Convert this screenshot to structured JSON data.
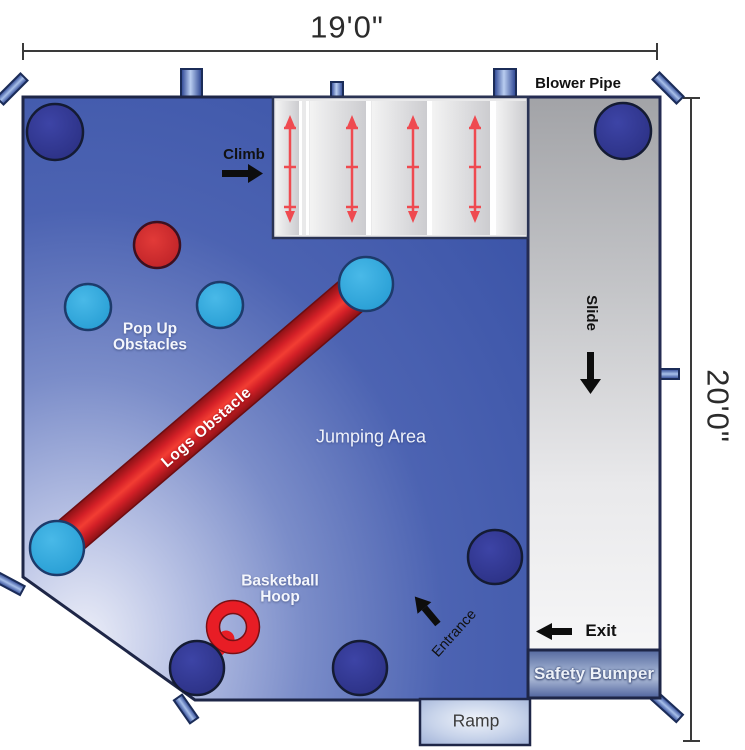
{
  "dimensions": {
    "width_label": "19'0\"",
    "height_label": "20'0\""
  },
  "labels": {
    "blower_pipe": "Blower Pipe",
    "climb": "Climb",
    "slide": "Slide",
    "pop_up_line1": "Pop Up",
    "pop_up_line2": "Obstacles",
    "logs_obstacle": "Logs Obstacle",
    "jumping_area": "Jumping Area",
    "basketball_line1": "Basketball",
    "basketball_line2": "Hoop",
    "entrance": "Entrance",
    "exit": "Exit",
    "safety_bumper": "Safety Bumper",
    "ramp": "Ramp"
  },
  "colors": {
    "jump_area_blue": "#3f58ab",
    "jump_area_light": "#e8ebf7",
    "obstacle_navy": "#2f3590",
    "obstacle_cyan": "#2aa7dd",
    "obstacle_red": "#cd2128",
    "log_red": "#e01d24",
    "hoop_red": "#ee1c25",
    "slide_gray": "#a9aaae",
    "bumper_blue": "#6a7fb4",
    "ramp_blue": "#9fb0d8",
    "outline_navy": "#1e2647",
    "climb_wall_gray": "#e4e4e6"
  }
}
